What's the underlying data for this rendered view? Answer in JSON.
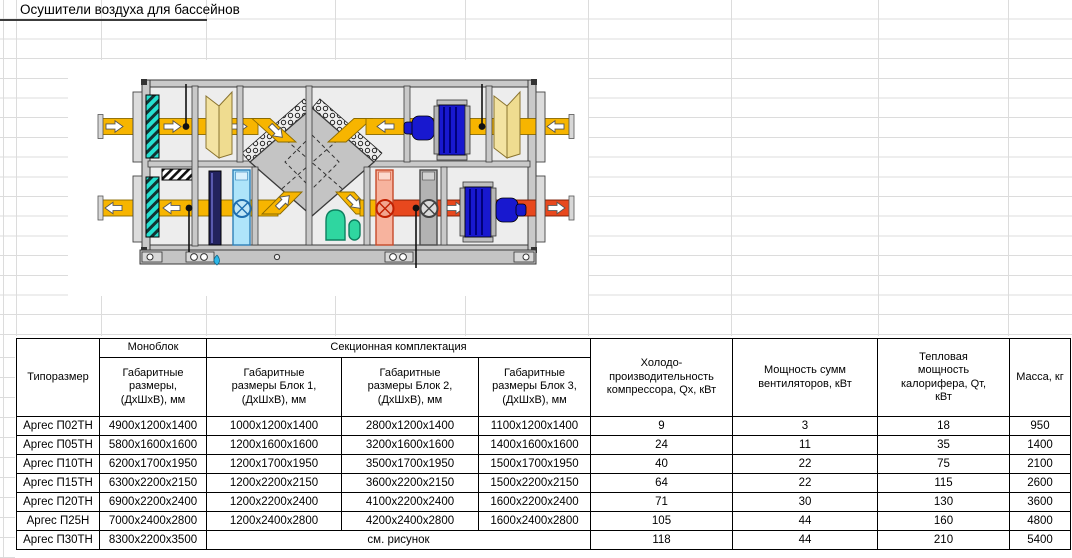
{
  "title": "Осушители воздуха для бассейнов",
  "table": {
    "header": {
      "col_tiporazmer": "Типоразмер",
      "group_monoblock": "Моноблок",
      "group_sectional": "Секционная комплектация",
      "col_mono_dims": "Габаритные\nразмеры,\n(ДхШхВ), мм",
      "col_block1": "Габаритные\nразмеры Блок 1,\n(ДхШхВ), мм",
      "col_block2": "Габаритные\nразмеры Блок 2,\n(ДхШхВ), мм",
      "col_block3": "Габаритные\nразмеры Блок 3,\n(ДхШхВ), мм",
      "col_cooling": "Холодо-\nпроизводительность\nкомпрессора, Qх, кВт",
      "col_fan_power": "Мощность сумм\nвентиляторов, кВт",
      "col_heat_power": "Тепловая\nмощность\nкалорифера, Qт,\nкВт",
      "col_mass": "Масса, кг"
    },
    "rows": [
      {
        "model": "Аргес П02ТН",
        "mono": "4900х1200х1400",
        "block1": "1000х1200х1400",
        "block2": "2800х1200х1400",
        "block3": "1100х1200х1400",
        "qx": "9",
        "fans": "3",
        "qt": "18",
        "mass": "950"
      },
      {
        "model": "Аргес П05ТН",
        "mono": "5800х1600х1600",
        "block1": "1200х1600х1600",
        "block2": "3200х1600х1600",
        "block3": "1400х1600х1600",
        "qx": "24",
        "fans": "11",
        "qt": "35",
        "mass": "1400"
      },
      {
        "model": "Аргес П10ТН",
        "mono": "6200х1700х1950",
        "block1": "1200х1700х1950",
        "block2": "3500х1700х1950",
        "block3": "1500х1700х1950",
        "qx": "40",
        "fans": "22",
        "qt": "75",
        "mass": "2100"
      },
      {
        "model": "Аргес П15ТН",
        "mono": "6300х2200х2150",
        "block1": "1200х2200х2150",
        "block2": "3600х2200х2150",
        "block3": "1500х2200х2150",
        "qx": "64",
        "fans": "22",
        "qt": "115",
        "mass": "2600"
      },
      {
        "model": "Аргес П20ТН",
        "mono": "6900х2200х2400",
        "block1": "1200х2200х2400",
        "block2": "4100х2200х2400",
        "block3": "1600х2200х2400",
        "qx": "71",
        "fans": "30",
        "qt": "130",
        "mass": "3600"
      },
      {
        "model": "Аргес П25Н",
        "mono": "7000х2400х2800",
        "block1": "1200х2400х2800",
        "block2": "4200х2400х2800",
        "block3": "1600х2400х2800",
        "qx": "105",
        "fans": "44",
        "qt": "160",
        "mass": "4800"
      },
      {
        "model": "Аргес П30ТН",
        "mono": "8300х2200х3500",
        "merged": "см. рисунок",
        "qx": "118",
        "fans": "44",
        "qt": "210",
        "mass": "5400"
      }
    ]
  },
  "diagram": {
    "colors": {
      "supply_duct": "#F7B500",
      "exhaust_duct": "#E8481E",
      "fan": "#1818CF",
      "filter": "#26E0D0",
      "cooler": "#AEE4FA",
      "heater": "#F7B39E",
      "damper": "#F3E3A2",
      "frame": "#C9C9C9",
      "drain": "#2FD6A0"
    }
  }
}
